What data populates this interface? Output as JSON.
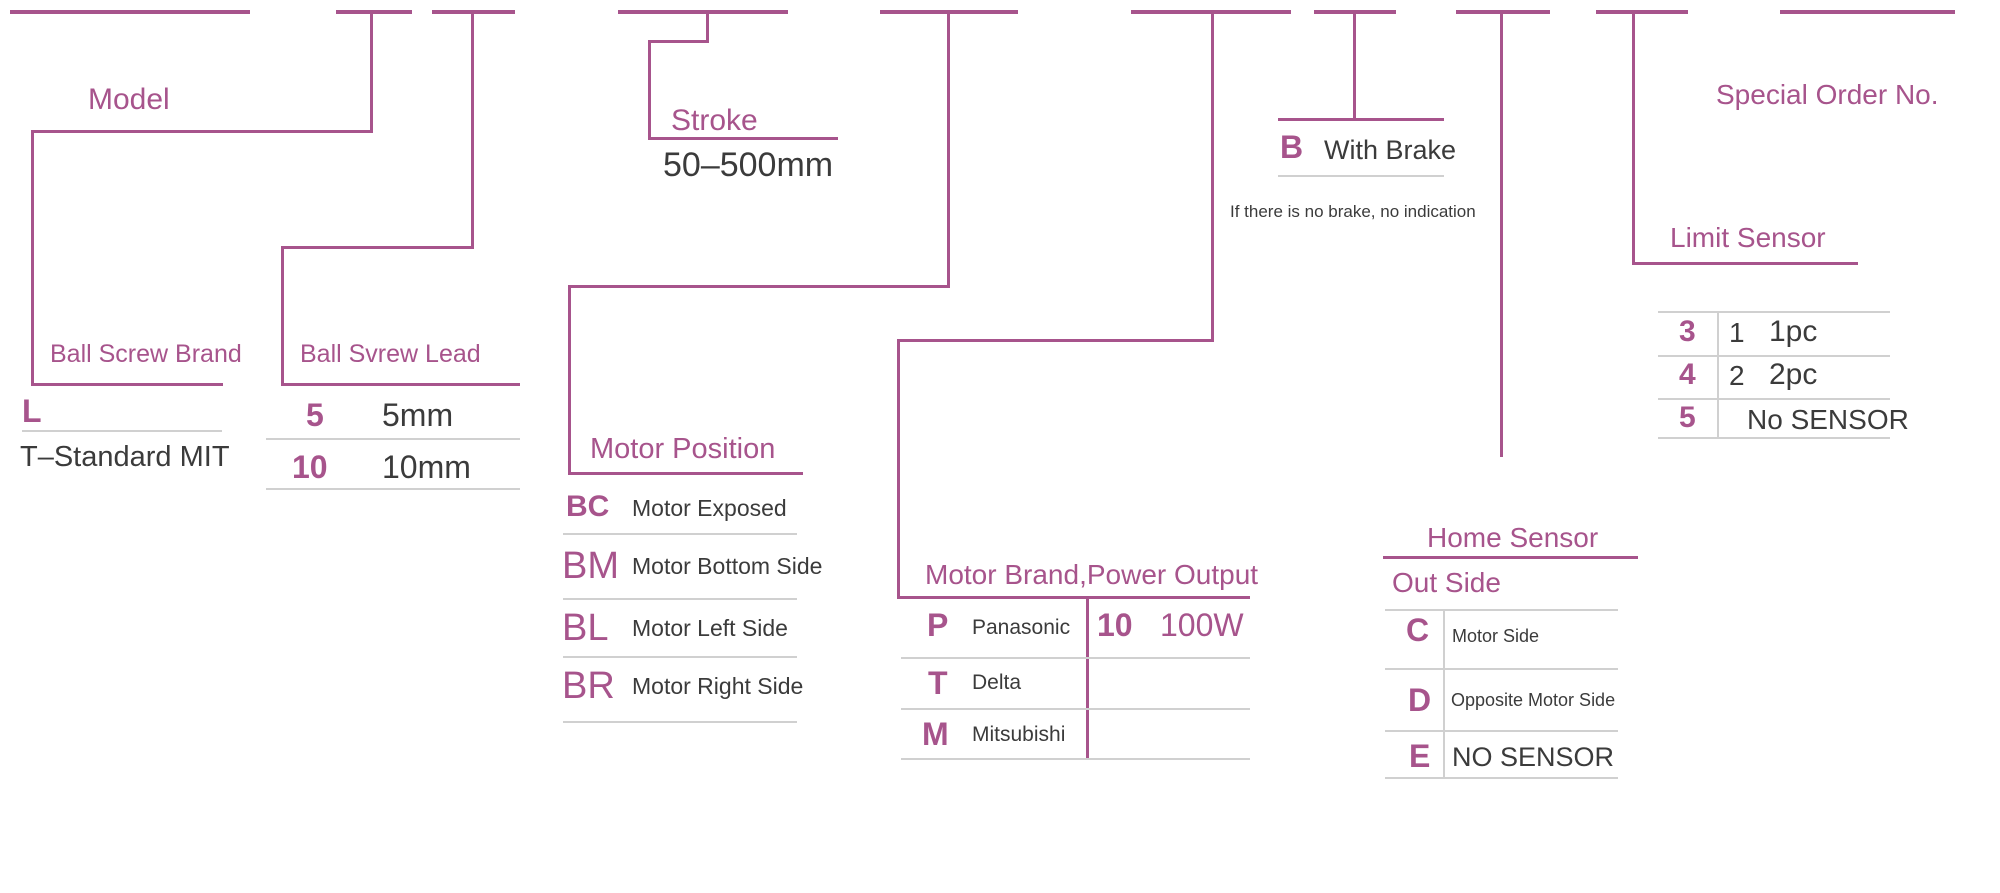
{
  "colors": {
    "accent": "#a7548c",
    "text": "#3b3b3b",
    "divider": "#d0d0d0",
    "background": "#ffffff"
  },
  "model_label": "Model",
  "special_order_label": "Special Order No.",
  "stroke": {
    "title": "Stroke",
    "range": "50–500mm"
  },
  "ball_screw_brand": {
    "title": "Ball Screw Brand",
    "code": "L",
    "desc": "T–Standard MIT"
  },
  "ball_screw_lead": {
    "title": "Ball Svrew Lead",
    "rows": [
      {
        "code": "5",
        "desc": "5mm"
      },
      {
        "code": "10",
        "desc": "10mm"
      }
    ]
  },
  "motor_position": {
    "title": "Motor Position",
    "rows": [
      {
        "code": "BC",
        "desc": "Motor Exposed"
      },
      {
        "code": "BM",
        "desc": "Motor Bottom Side"
      },
      {
        "code": "BL",
        "desc": "Motor Left Side"
      },
      {
        "code": "BR",
        "desc": "Motor Right Side"
      }
    ]
  },
  "motor_brand": {
    "title": "Motor Brand,Power Output",
    "rows": [
      {
        "code": "P",
        "desc": "Panasonic",
        "power_code": "10",
        "power": "100W"
      },
      {
        "code": "T",
        "desc": "Delta",
        "power_code": "",
        "power": ""
      },
      {
        "code": "M",
        "desc": "Mitsubishi",
        "power_code": "",
        "power": ""
      }
    ]
  },
  "brake": {
    "code": "B",
    "desc": "With Brake",
    "note": "If there is no brake, no indication"
  },
  "home_sensor": {
    "title": "Home Sensor",
    "subtitle": "Out Side",
    "rows": [
      {
        "code": "C",
        "desc": "Motor Side"
      },
      {
        "code": "D",
        "desc": "Opposite Motor Side"
      },
      {
        "code": "E",
        "desc": "NO SENSOR"
      }
    ]
  },
  "limit_sensor": {
    "title": "Limit Sensor",
    "rows": [
      {
        "code": "3",
        "qty": "1",
        "desc": "1pc"
      },
      {
        "code": "4",
        "qty": "2",
        "desc": "2pc"
      },
      {
        "code": "5",
        "qty": "",
        "desc": "No SENSOR"
      }
    ]
  }
}
